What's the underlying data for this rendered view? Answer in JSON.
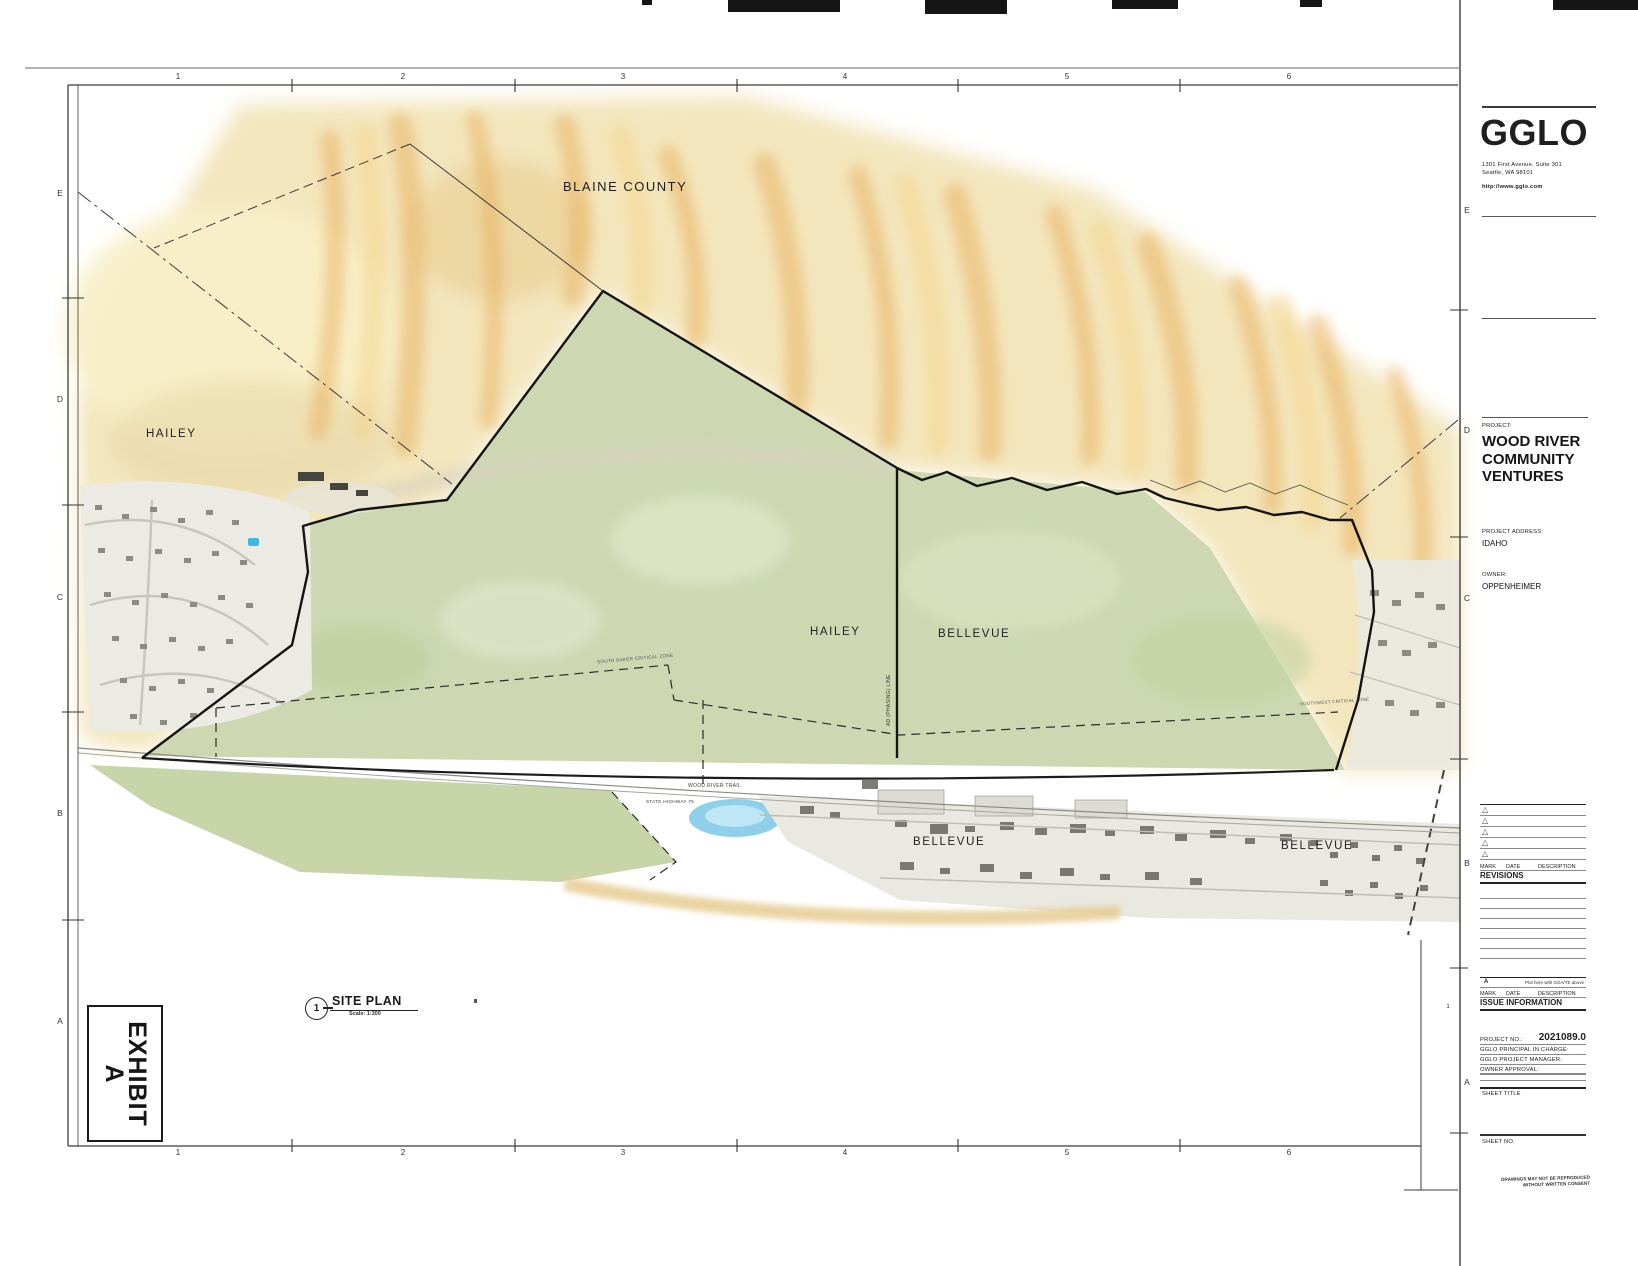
{
  "grid": {
    "top": [
      "1",
      "2",
      "3",
      "4",
      "5",
      "6"
    ],
    "bottom": [
      "1",
      "2",
      "3",
      "4",
      "5",
      "6"
    ],
    "left": [
      "E",
      "D",
      "C",
      "B",
      "A"
    ],
    "right": [
      "E",
      "D",
      "C",
      "B",
      "A"
    ],
    "right_extra": "1"
  },
  "titleblock": {
    "logo": "GGLO",
    "address_line1": "1301 First Avenue, Suite 301",
    "address_line2": "Seattle, WA 98101",
    "website": "http://www.gglo.com",
    "project_label": "PROJECT:",
    "project_name_line1": "WOOD RIVER",
    "project_name_line2": "COMMUNITY VENTURES",
    "project_address_label": "PROJECT ADDRESS:",
    "project_address": "IDAHO",
    "owner_label": "OWNER:",
    "owner_name": "OPPENHEIMER",
    "revisions": {
      "delta_icon": "△",
      "mark": "MARK",
      "date": "DATE",
      "description": "DESCRIPTION",
      "title": "REVISIONS"
    },
    "issue": {
      "row_mark": "A",
      "row_note": "Plot here with GGA/TE above",
      "mark": "MARK",
      "date": "DATE",
      "description": "DESCRIPTION",
      "title": "ISSUE INFORMATION"
    },
    "project_no_label": "PROJECT NO.:",
    "project_no_value": "2021089.0",
    "principal_label": "GGLO PRINCIPAL IN CHARGE:",
    "manager_label": "GGLO PROJECT MANAGER:",
    "owner_approval_label": "OWNER APPROVAL:",
    "sheet_title_label": "SHEET TITLE",
    "sheet_no_label": "SHEET NO.",
    "fine_print_line1": "DRAWINGS MAY NOT BE REPRODUCED",
    "fine_print_line2": "WITHOUT WRITTEN CONSENT"
  },
  "map": {
    "labels": {
      "blaine_county": "BLAINE COUNTY",
      "hailey_nw": "HAILEY",
      "hailey_center": "HAILEY",
      "bellevue_center": "BELLEVUE",
      "bellevue_south": "BELLEVUE",
      "bellevue_east": "BELLEVUE",
      "critical_zone_west": "SOUTH BAKER CRITICAL ZONE",
      "critical_zone_east": "SOUTHWEST CRITICAL ZONE",
      "phasing_line": "AD (PHASING) LINE",
      "trail": "WOOD RIVER TRAIL",
      "highway": "STATE HIGHWAY 75"
    }
  },
  "callout": {
    "number": "1",
    "title": "SITE PLAN",
    "scale": "Scale: 1:300"
  },
  "exhibit": {
    "line1": "EXHIBIT",
    "line2": "A"
  },
  "colors": {
    "terrain_tan": "#f3e6bd",
    "ridge_orange": "#e6a94f",
    "valley_green": "#cdd8b2",
    "pond_blue": "#8ecfe9",
    "ink": "#222222"
  }
}
